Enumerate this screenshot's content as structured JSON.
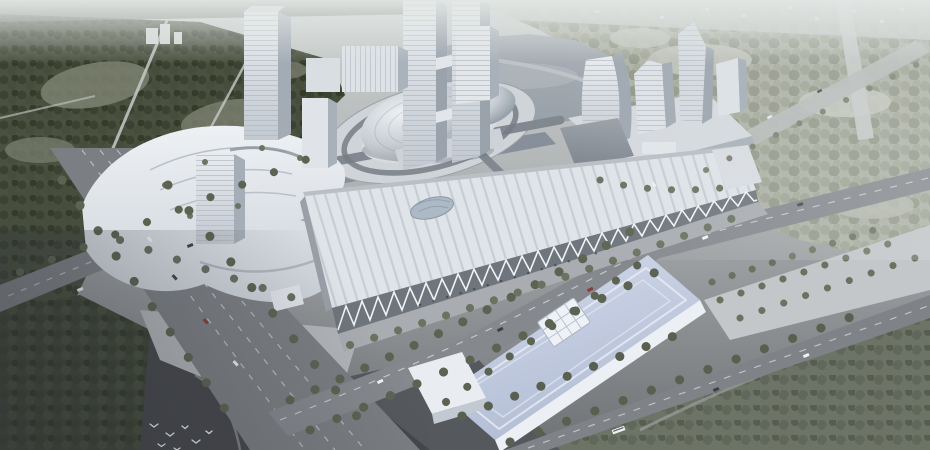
{
  "image": {
    "kind": "architectural-aerial-rendering",
    "subject": "Bird's-eye concept rendering of a convention and exhibition district: a silver oval dome pavilion on a ring plaza beside a lake, a long truss-front exhibition hall, a blue-roofed arena, white high-rise towers, tree-lined boulevards and surrounding forest"
  },
  "palette": {
    "haze_top": "#e3e7e5",
    "ground_base_top": "#ccd1d0",
    "ground_base_bottom": "#6f7275",
    "forest_nw": "#4a5140",
    "forest_ne": "#aeb2a7",
    "forest_se": "#6e7465",
    "clearing": "#7d8171",
    "water": "#98a0a8",
    "water_light": "#c2c8cc",
    "road": "#7b7f83",
    "road_light": "#c6cac9",
    "pavement_dark": "#55585c",
    "pavement_darker": "#45474b",
    "plaza_ring": "#cfd4d9",
    "plaza_left": "#b2b6ba",
    "plaza_east": "#c3c7ca",
    "dome_highlight": "#eef1f4",
    "dome_shadow": "#848e99",
    "tower_face": "#e8ecef",
    "tower_side": "#9ba3ad",
    "hall_roof": "#dfe4e9",
    "hall_roof_stripe": "#c7cdd4",
    "truss_white": "#f1f4f6",
    "facade_glass": "#6f757c",
    "arena_roof_light": "#d3daea",
    "arena_roof_dark": "#b2bdd5",
    "arena_facade": "#eceff3",
    "annex_roof": "#9aa1a8",
    "tree_row_dark": "#5c6352",
    "tree_row_mid": "#6b7260",
    "tree_row_light": "#7a8170",
    "lane_marking": "#d3d7d9",
    "car_white": "#f2f4f5",
    "car_dark": "#3c4045",
    "car_red": "#8a3a38",
    "bird_white": "#f6f7f8"
  },
  "scene": {
    "landmarks": [
      "northwest-forest",
      "central-lake",
      "oval-dome-pavilion",
      "ring-plaza",
      "twin-towers",
      "left-cultural-complex",
      "exhibition-hall-truss-facade",
      "blue-roof-arena",
      "right-tower-cluster",
      "boulevard-intersection",
      "tree-lined-avenues",
      "flying-birds",
      "southeast-forest",
      "hazy-horizon"
    ]
  }
}
